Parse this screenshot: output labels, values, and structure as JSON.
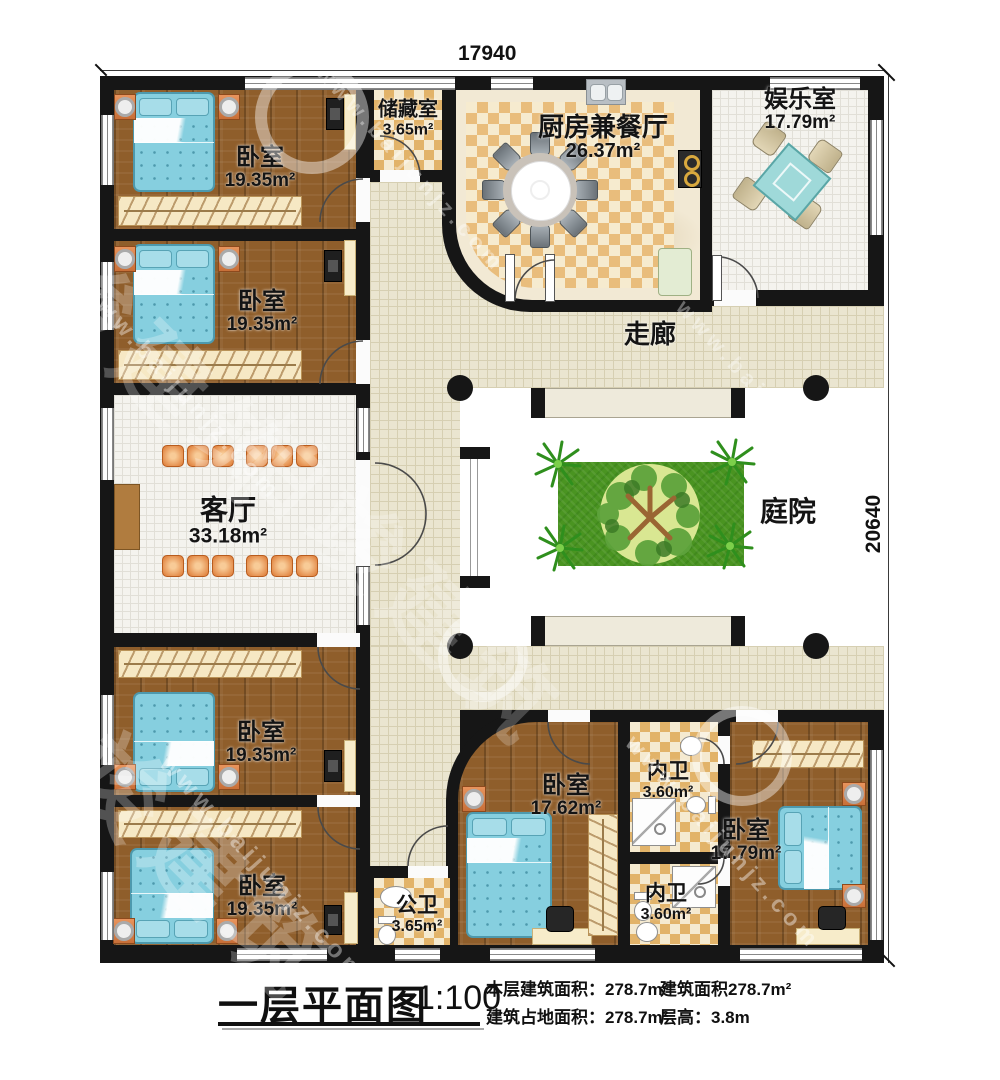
{
  "drawing": {
    "type": "floor-plan",
    "dimensions": {
      "top": "17940",
      "right": "20640"
    }
  },
  "rooms": [
    {
      "id": "bedroom-1",
      "name": "卧室",
      "area": "19.35m²"
    },
    {
      "id": "bedroom-2",
      "name": "卧室",
      "area": "19.35m²"
    },
    {
      "id": "storage",
      "name": "储藏室",
      "area": "3.65m²"
    },
    {
      "id": "kitchen-dining",
      "name": "厨房兼餐厅",
      "area": "26.37m²"
    },
    {
      "id": "recreation",
      "name": "娱乐室",
      "area": "17.79m²"
    },
    {
      "id": "corridor",
      "name": "走廊",
      "area": ""
    },
    {
      "id": "living-room",
      "name": "客厅",
      "area": "33.18m²"
    },
    {
      "id": "courtyard",
      "name": "庭院",
      "area": ""
    },
    {
      "id": "bedroom-3",
      "name": "卧室",
      "area": "19.35m²"
    },
    {
      "id": "bedroom-4",
      "name": "卧室",
      "area": "19.35m²"
    },
    {
      "id": "public-bath",
      "name": "公卫",
      "area": "3.65m²"
    },
    {
      "id": "bedroom-5",
      "name": "卧室",
      "area": "17.62m²"
    },
    {
      "id": "ensuite-bath-1",
      "name": "内卫",
      "area": "3.60m²"
    },
    {
      "id": "ensuite-bath-2",
      "name": "内卫",
      "area": "3.60m²"
    },
    {
      "id": "bedroom-6",
      "name": "卧室",
      "area": "17.79m²"
    }
  ],
  "title_block": {
    "title": "一层平面图",
    "scale": "1:100",
    "stats": [
      {
        "label": "本层建筑面积：",
        "value": "278.7m²"
      },
      {
        "label": "建筑面积",
        "value": "278.7m²"
      },
      {
        "label": "建筑占地面积：",
        "value": "278.7m²"
      },
      {
        "label": "层高：",
        "value": "3.8m"
      }
    ]
  },
  "watermark": {
    "brand": "柏竣建筑",
    "url": "www.baijunjz.com"
  },
  "colors": {
    "wall": "#161616",
    "wood_floor": "#8f5e2b",
    "corridor_tile": "#eae5d0",
    "kitchen_checker": "#e9bd7c",
    "bath_checker": "#e2b369",
    "lawn": "#4a9421",
    "bed": "#86cfdf",
    "accent_orange": "#d9834e"
  }
}
